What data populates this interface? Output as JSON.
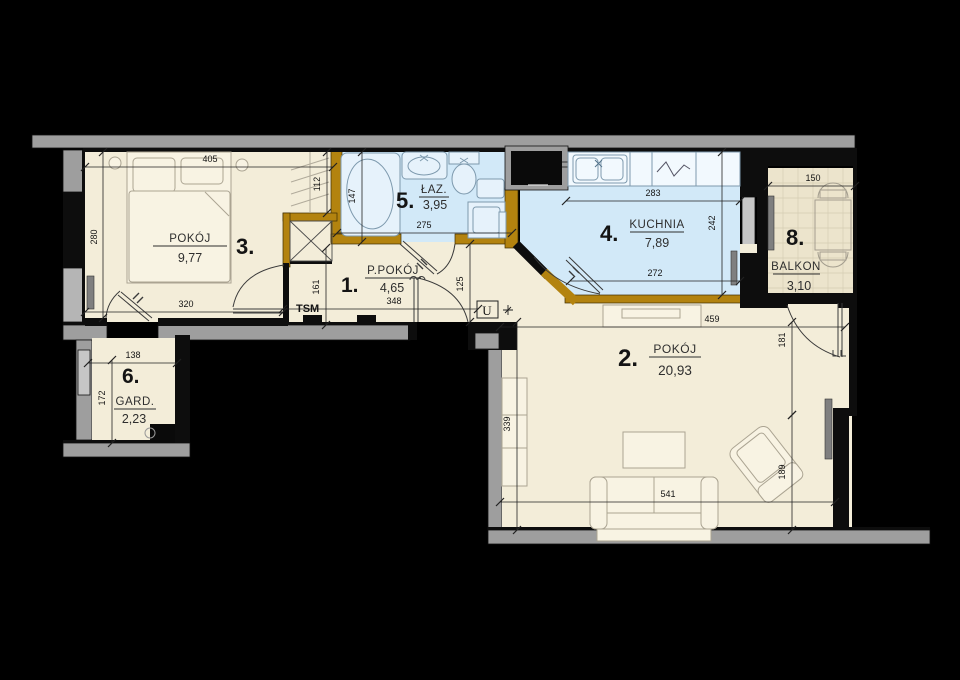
{
  "plan": {
    "rooms": [
      {
        "number": "1.",
        "name": "P.POKÓJ",
        "area": "4,65"
      },
      {
        "number": "2.",
        "name": "POKÓJ",
        "area": "20,93"
      },
      {
        "number": "3.",
        "name": "POKÓJ",
        "area": "9,77"
      },
      {
        "number": "4.",
        "name": "KUCHNIA",
        "area": "7,89"
      },
      {
        "number": "5.",
        "name": "ŁAZ.",
        "area": "3,95"
      },
      {
        "number": "6.",
        "name": "GARD.",
        "area": "2,23"
      },
      {
        "number": "8.",
        "name": "BALKON",
        "area": "3,10"
      }
    ],
    "annotations": {
      "tsm": "TSM",
      "u": "U"
    },
    "dimensions": [
      {
        "v": "405",
        "x1": 85,
        "y1": 167,
        "x2": 333,
        "y2": 167,
        "lx": 210,
        "ly": 162,
        "vert": false
      },
      {
        "v": "280",
        "x1": 103,
        "y1": 152,
        "x2": 103,
        "y2": 318,
        "lx": 97,
        "ly": 237,
        "vert": true
      },
      {
        "v": "320",
        "x1": 85,
        "y1": 312,
        "x2": 283,
        "y2": 312,
        "lx": 186,
        "ly": 307,
        "vert": false
      },
      {
        "v": "112",
        "x1": 327,
        "y1": 152,
        "x2": 327,
        "y2": 213,
        "lx": 320,
        "ly": 184,
        "vert": true
      },
      {
        "v": "161",
        "x1": 326,
        "y1": 248,
        "x2": 326,
        "y2": 325,
        "lx": 319,
        "ly": 287,
        "vert": true
      },
      {
        "v": "147",
        "x1": 362,
        "y1": 152,
        "x2": 362,
        "y2": 242,
        "lx": 355,
        "ly": 196,
        "vert": true
      },
      {
        "v": "275",
        "x1": 337,
        "y1": 233,
        "x2": 512,
        "y2": 233,
        "lx": 424,
        "ly": 228,
        "vert": false
      },
      {
        "v": "348",
        "x1": 283,
        "y1": 309,
        "x2": 478,
        "y2": 309,
        "lx": 394,
        "ly": 304,
        "vert": false
      },
      {
        "v": "125",
        "x1": 470,
        "y1": 244,
        "x2": 470,
        "y2": 322,
        "lx": 463,
        "ly": 284,
        "vert": true
      },
      {
        "v": "283",
        "x1": 566,
        "y1": 201,
        "x2": 740,
        "y2": 201,
        "lx": 653,
        "ly": 196,
        "vert": false
      },
      {
        "v": "242",
        "x1": 722,
        "y1": 152,
        "x2": 722,
        "y2": 295,
        "lx": 715,
        "ly": 223,
        "vert": true
      },
      {
        "v": "272",
        "x1": 570,
        "y1": 281,
        "x2": 740,
        "y2": 281,
        "lx": 655,
        "ly": 276,
        "vert": false
      },
      {
        "v": "459",
        "x1": 500,
        "y1": 327,
        "x2": 845,
        "y2": 327,
        "lx": 712,
        "ly": 322,
        "vert": false
      },
      {
        "v": "339",
        "x1": 517,
        "y1": 322,
        "x2": 517,
        "y2": 530,
        "lx": 510,
        "ly": 424,
        "vert": true
      },
      {
        "v": "181",
        "x1": 792,
        "y1": 322,
        "x2": 792,
        "y2": 415,
        "lx": 785,
        "ly": 340,
        "vert": true
      },
      {
        "v": "189",
        "x1": 792,
        "y1": 415,
        "x2": 792,
        "y2": 530,
        "lx": 785,
        "ly": 472,
        "vert": true
      },
      {
        "v": "541",
        "x1": 500,
        "y1": 502,
        "x2": 835,
        "y2": 502,
        "lx": 668,
        "ly": 497,
        "vert": false
      },
      {
        "v": "138",
        "x1": 88,
        "y1": 363,
        "x2": 177,
        "y2": 363,
        "lx": 133,
        "ly": 358,
        "vert": false
      },
      {
        "v": "172",
        "x1": 112,
        "y1": 360,
        "x2": 112,
        "y2": 443,
        "lx": 105,
        "ly": 398,
        "vert": true
      },
      {
        "v": "150",
        "x1": 768,
        "y1": 186,
        "x2": 855,
        "y2": 186,
        "lx": 813,
        "ly": 181,
        "vert": false
      }
    ],
    "colors": {
      "background": "#000000",
      "wall_gray": "#9e9e9e",
      "partition_ochre": "#b3830f",
      "room_fill": "#f3edd9",
      "wet_room_fill": "#d2e9f8",
      "balcony_fill": "#ece4cc"
    }
  }
}
